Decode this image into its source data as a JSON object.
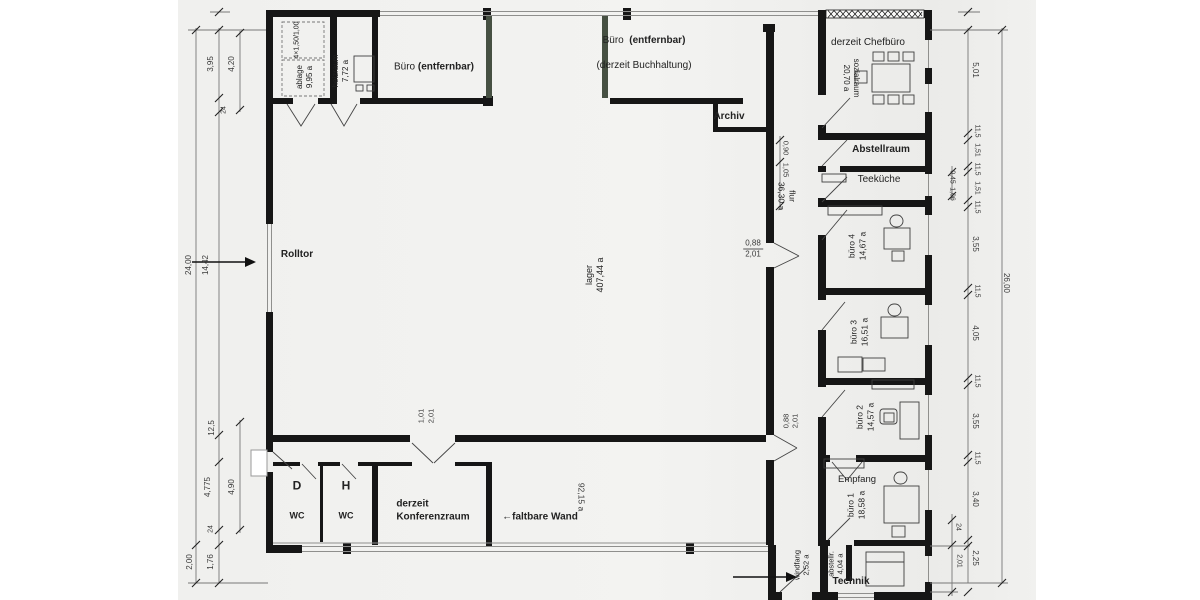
{
  "colors": {
    "wall": "#161616",
    "paper": "#f2f2f0",
    "dimension": "#555555",
    "tinted_wall": "#465042"
  },
  "labels": {
    "shelf_note": "4×1,50/1,00",
    "ablage": "ablage\n9,95 a",
    "heizraum": "heizraum\n7,72 a",
    "buero_name": "Büro",
    "buero_suffix": "(entfernbar)",
    "buch_name": "Büro",
    "buch_suffix": "(entfernbar)",
    "buch_sub": "(derzeit Buchhaltung)",
    "archiv": "Archiv",
    "chefbuero": "derzeit Chefbüro",
    "sozialraum": "sozialraum\n20,70 a",
    "abstellraum": "Abstellraum",
    "teekueche": "Teeküche",
    "buero4": "büro 4\n14,67 a",
    "buero3": "büro 3\n16,51 a",
    "buero2": "büro 2\n14,57 a",
    "empfang": "Empfang",
    "buero1": "büro 1\n18,58 a",
    "windfang": "windfang\n2,52 a",
    "abstellr": "abstellr.\n4,04 a",
    "technik": "Technik",
    "wc_d": "D",
    "wc_h": "H",
    "wc_sub": "WC",
    "konferenz": "derzeit\nKonferenzraum",
    "faltbare_arrow": "←",
    "faltbare": "faltbare Wand",
    "area92": "92,15 a",
    "lager": "lager\n407,44 a",
    "flur": "flur\n36,30 a",
    "rolltor": "Rolltor"
  },
  "door_dims": {
    "hall_w": "0,88",
    "hall_h": "2,01",
    "strip_w": "0,88",
    "strip_h": "2,01",
    "konf_w": "1,01",
    "konf_h": "2,01",
    "flur_a": "0,90",
    "flur_b": "1,05"
  },
  "dims": {
    "left": [
      "24,00",
      "14,42",
      "3,95",
      "4,20",
      "24",
      "12,5",
      "4,775",
      "4,90",
      "24",
      "2,00",
      "1,76"
    ],
    "right": [
      "5,01",
      "11,5",
      "1,51",
      "11,5",
      "1,51",
      "11,5",
      "0,45",
      "1,06",
      "3,55",
      "11,5",
      "26,00",
      "4,05",
      "11,5",
      "3,55",
      "11,5",
      "3,40",
      "24",
      "2,25",
      "2,01"
    ]
  }
}
